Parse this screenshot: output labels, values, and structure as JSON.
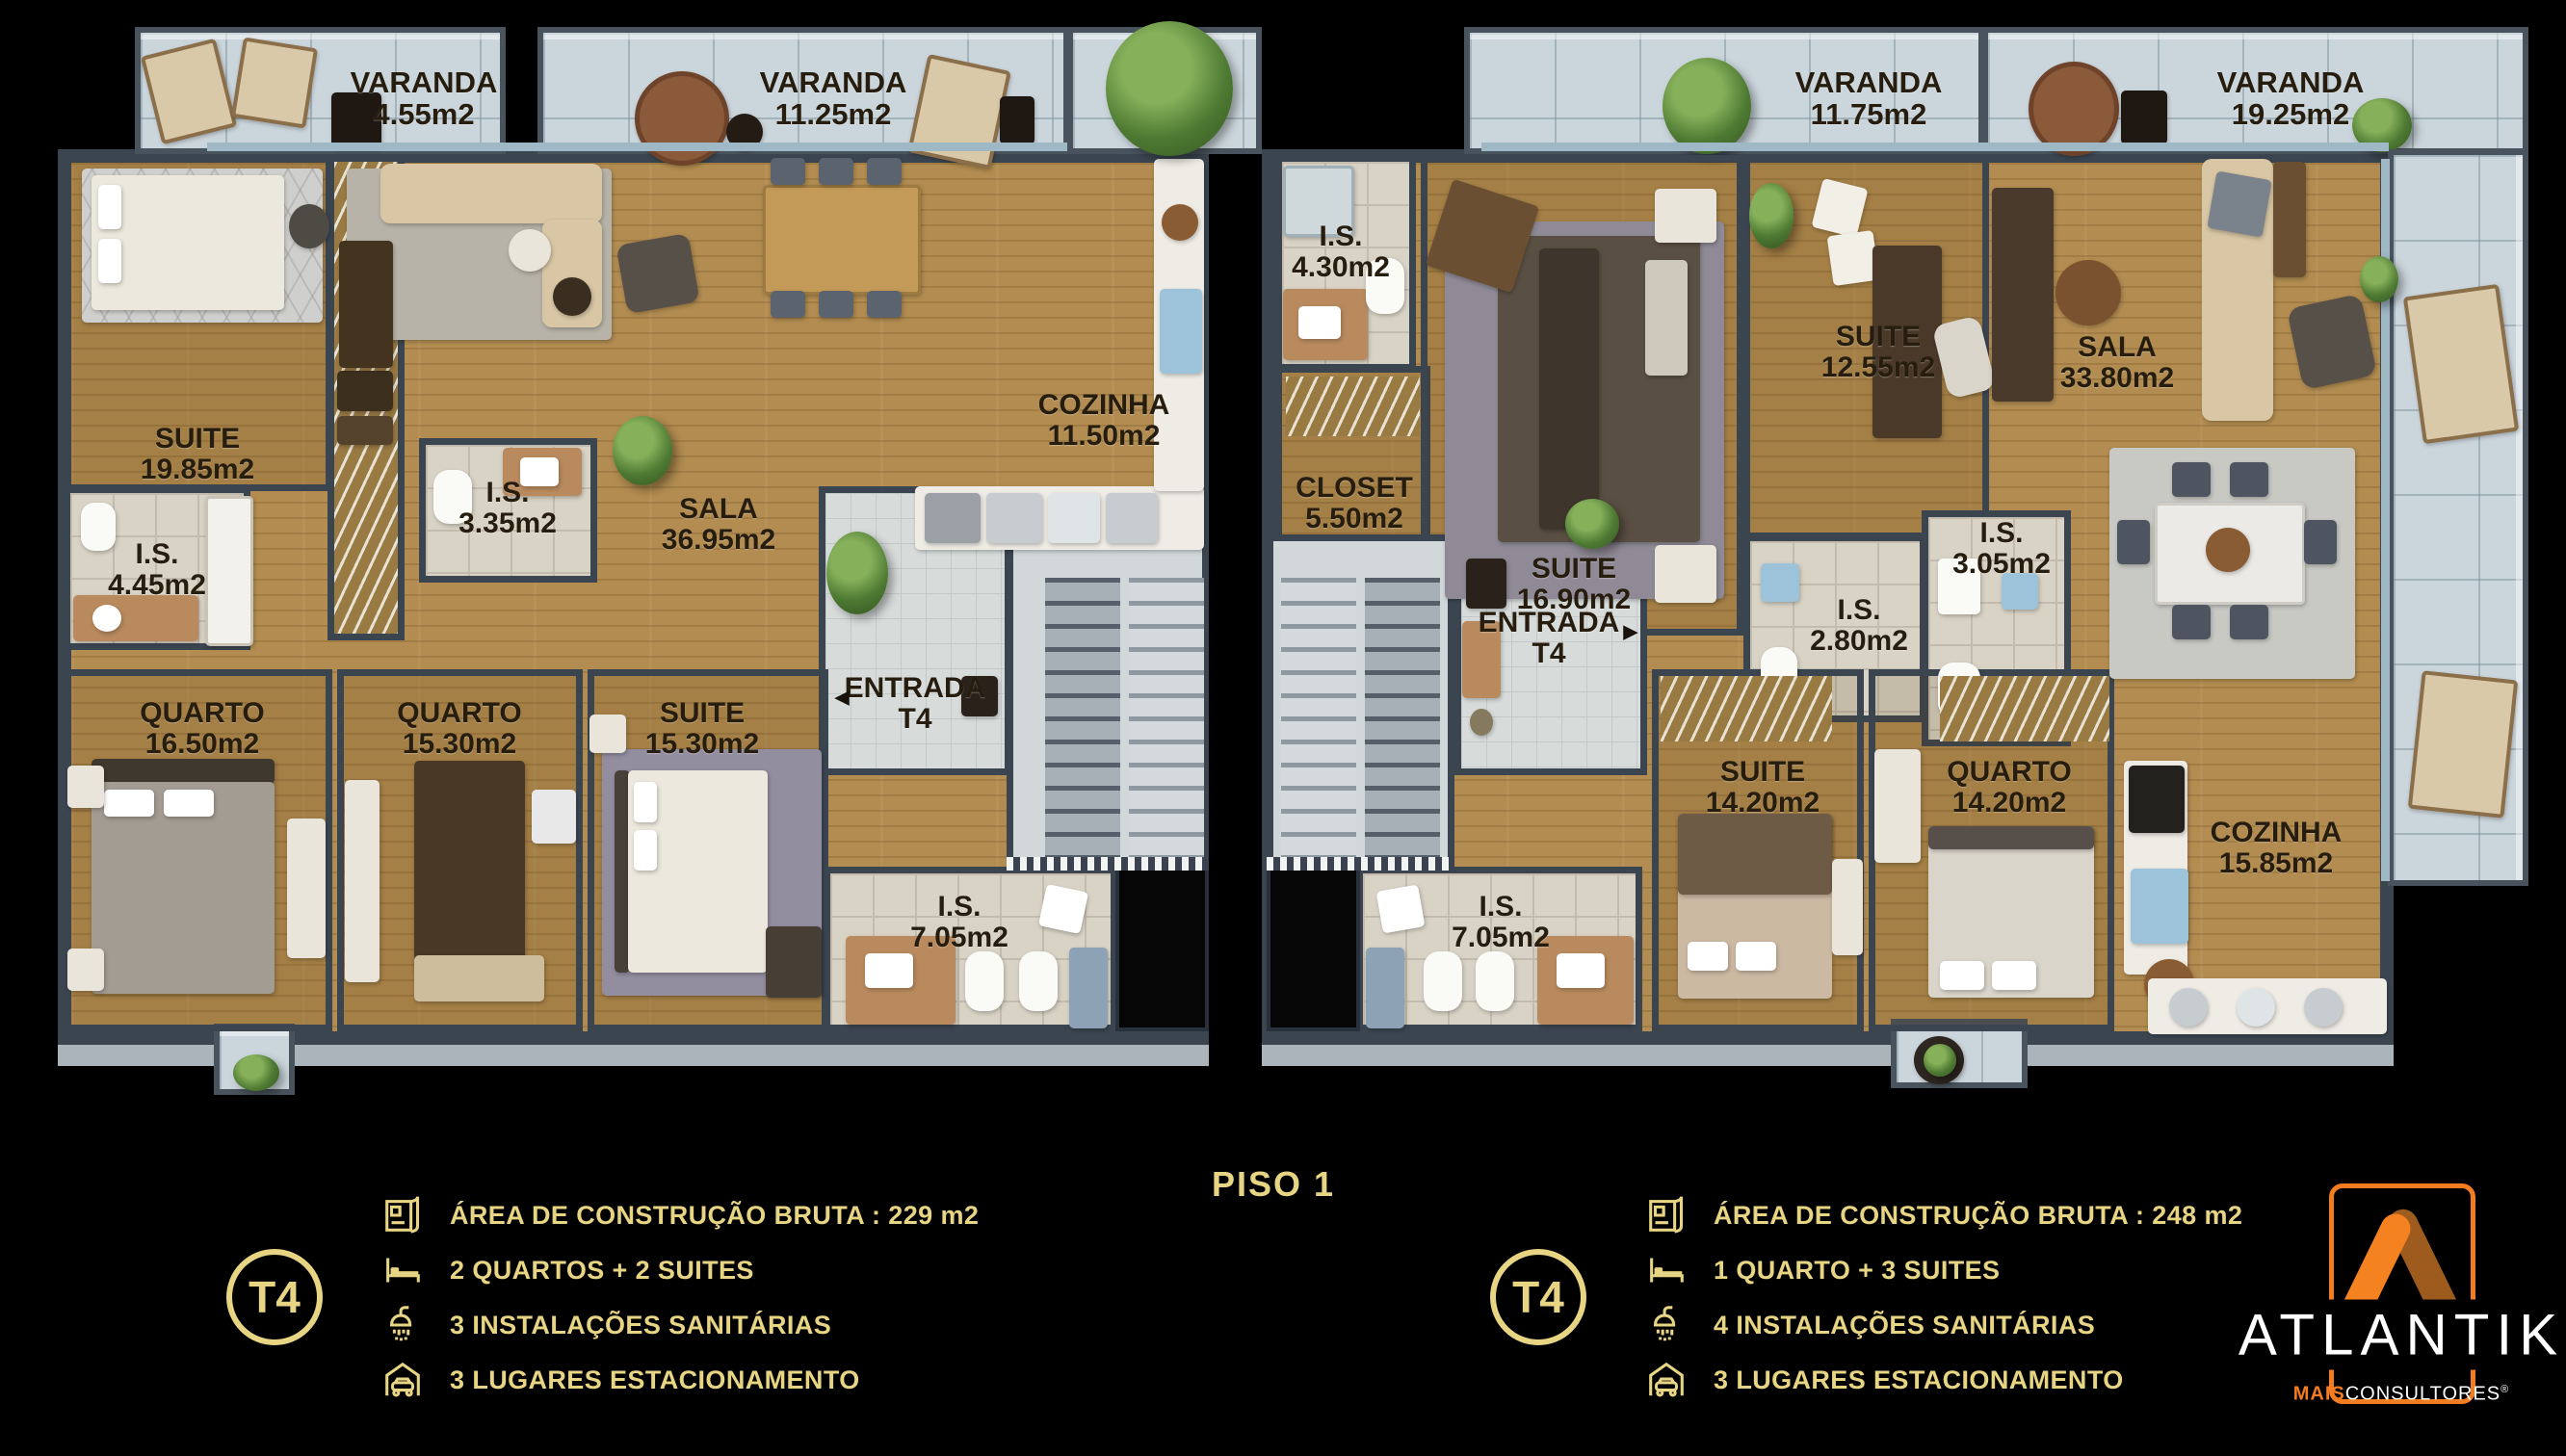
{
  "title": "PISO 1",
  "plan": {
    "varandas": [
      {
        "name": "VARANDA",
        "area": "4.55m2"
      },
      {
        "name": "VARANDA",
        "area": "11.25m2"
      },
      {
        "name": "VARANDA",
        "area": "11.75m2"
      },
      {
        "name": "VARANDA",
        "area": "19.25m2"
      }
    ],
    "unit_left": {
      "rooms": {
        "suite19": {
          "name": "SUITE",
          "area": "19.85m2"
        },
        "is445": {
          "name": "I.S.",
          "area": "4.45m2"
        },
        "is335": {
          "name": "I.S.",
          "area": "3.35m2"
        },
        "sala": {
          "name": "SALA",
          "area": "36.95m2"
        },
        "cozinha": {
          "name": "COZINHA",
          "area": "11.50m2"
        },
        "entrada": {
          "name": "ENTRADA",
          "area": "T4",
          "arrow": "◄"
        },
        "q1650": {
          "name": "QUARTO",
          "area": "16.50m2"
        },
        "q1530": {
          "name": "QUARTO",
          "area": "15.30m2"
        },
        "s1530": {
          "name": "SUITE",
          "area": "15.30m2"
        },
        "is705": {
          "name": "I.S.",
          "area": "7.05m2"
        }
      }
    },
    "unit_right": {
      "rooms": {
        "is430": {
          "name": "I.S.",
          "area": "4.30m2"
        },
        "closet": {
          "name": "CLOSET",
          "area": "5.50m2"
        },
        "s1690": {
          "name": "SUITE",
          "area": "16.90m2"
        },
        "s1255": {
          "name": "SUITE",
          "area": "12.55m2"
        },
        "is280": {
          "name": "I.S.",
          "area": "2.80m2"
        },
        "is305": {
          "name": "I.S.",
          "area": "3.05m2"
        },
        "sala": {
          "name": "SALA",
          "area": "33.80m2"
        },
        "entrada": {
          "name": "ENTRADA",
          "area": "T4",
          "arrow": "►"
        },
        "is705": {
          "name": "I.S.",
          "area": "7.05m2"
        },
        "s1420": {
          "name": "SUITE",
          "area": "14.20m2"
        },
        "q1420": {
          "name": "QUARTO",
          "area": "14.20m2"
        },
        "cozinha": {
          "name": "COZINHA",
          "area": "15.85m2"
        }
      }
    }
  },
  "legend_left": {
    "badge": "T4",
    "rows": [
      {
        "icon": "floor-plan-icon",
        "label": "ÁREA DE CONSTRUÇÃO BRUTA :",
        "value": "229 m2"
      },
      {
        "icon": "bed-icon",
        "label": "2 QUARTOS + 2 SUITES",
        "value": ""
      },
      {
        "icon": "shower-icon",
        "label": "3 INSTALAÇÕES SANITÁRIAS",
        "value": ""
      },
      {
        "icon": "garage-icon",
        "label": "3 LUGARES ESTACIONAMENTO",
        "value": ""
      }
    ]
  },
  "legend_right": {
    "badge": "T4",
    "rows": [
      {
        "icon": "floor-plan-icon",
        "label": "ÁREA DE CONSTRUÇÃO BRUTA :",
        "value": "248 m2"
      },
      {
        "icon": "bed-icon",
        "label": "1 QUARTO + 3 SUITES",
        "value": ""
      },
      {
        "icon": "shower-icon",
        "label": "4 INSTALAÇÕES SANITÁRIAS",
        "value": ""
      },
      {
        "icon": "garage-icon",
        "label": "3 LUGARES ESTACIONAMENTO",
        "value": ""
      }
    ]
  },
  "brand": {
    "name": "ATLANTIK",
    "sub_bold": "MAIS",
    "sub_rest": "CONSULTORES",
    "reg": "®"
  },
  "colors": {
    "accent_gold": "#E7D584",
    "brand_orange": "#F47C20",
    "brand_orange_dark": "#A05A1B",
    "wall": "#3B4550",
    "wood": "#B28C50",
    "tile": "#D9D3C6",
    "concrete": "#CBD6DC"
  }
}
